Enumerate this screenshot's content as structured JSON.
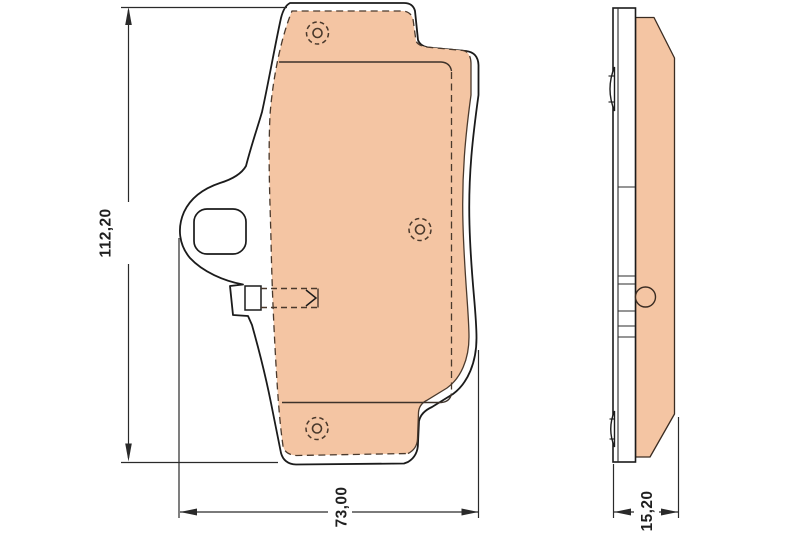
{
  "drawing": {
    "kind": "brake-pad-technical-drawing",
    "dimensions": {
      "height": "112,20",
      "width": "73,00",
      "thickness": "15,20"
    },
    "colors": {
      "pad_fill": "#f4c5a3",
      "outline": "#1b1b1b",
      "hidden_line": "#4a392c",
      "dimension_line": "#2a2a2a",
      "background": "#ffffff"
    }
  }
}
